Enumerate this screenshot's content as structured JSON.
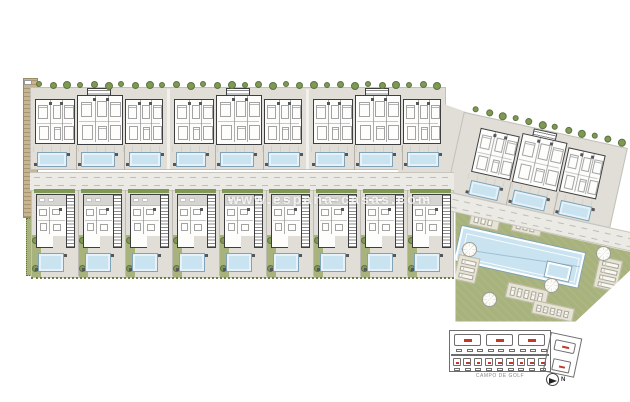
{
  "watermark": {
    "text": "www.espana-casas.com"
  },
  "keyplan": {
    "area_label": "CAMPO DE GOLF",
    "north_label": "N",
    "block_marks": 3,
    "villa_marks": 9,
    "annex_marks": 2
  },
  "site": {
    "apartment_blocks": 3,
    "units_per_block": 3,
    "angled_apartment_blocks": 1,
    "units_per_angled_block": 3,
    "detached_villas": 9,
    "private_pools": 21,
    "community_pools": 2,
    "street_trees_top": 30,
    "street_trees_angled": 12,
    "sun_umbrellas": 7,
    "lounger_pads": 6
  },
  "colors": {
    "paper": "#ffffff",
    "plot": "#e0ded6",
    "plot_line": "#c2c0b8",
    "wall": "#3e3e41",
    "room": "#fdfdfb",
    "roof": "#d6d5d1",
    "pool_fill": "#c9e3f0",
    "pool_edge": "#7fa3b8",
    "lawn": "#a8b27c",
    "hedge": "#7f9854",
    "tree": "#7f9854",
    "tree_dark": "#5c7340",
    "sand": "#c7b592",
    "sand_line": "#a8946e",
    "road": "#ebeae5",
    "walk_line": "#c7c5bd",
    "pad": "#e7e3d5",
    "pad_line": "#bdb9a5",
    "keyplan_line": "#6e6e6e",
    "keyplan_red": "#c0392b",
    "label": "#8a8a8a"
  }
}
